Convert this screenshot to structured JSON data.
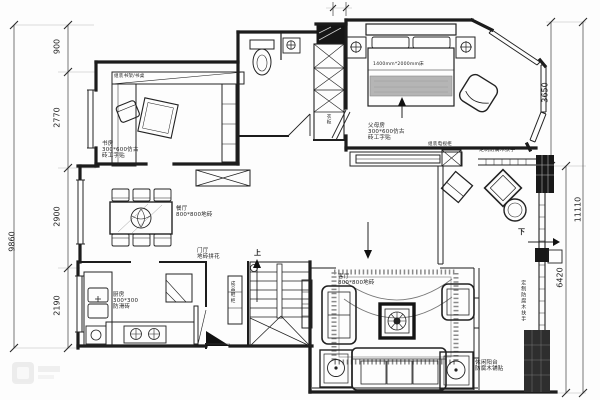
{
  "plan": {
    "dims": {
      "d900": "900",
      "d2770": "2770",
      "d2900": "2900",
      "d2190": "2190",
      "total_left": "9860",
      "d3650": "3650",
      "d6420": "6420",
      "total_right": "11110"
    },
    "rooms": {
      "study": {
        "l1": "书房",
        "l2": "300*600仿古",
        "l3": "砖工字贴"
      },
      "parents": {
        "l1": "父母房",
        "l2": "300*600仿古",
        "l3": "砖工字贴"
      },
      "dining": {
        "l1": "餐厅",
        "l2": "800*800地砖"
      },
      "living": {
        "l1": "客厅",
        "l2": "800*800地砖"
      },
      "kitchen": {
        "l1": "厨房",
        "l2": "300*300",
        "l3": "防滑砖"
      },
      "hall": {
        "l1": "门厅",
        "l2": "地砖拼花"
      },
      "balcony": {
        "l1": "休闲阳台",
        "l2": "防腐木铺贴"
      }
    },
    "furniture": {
      "bookshelf": "组装书架/书桌",
      "bed": "1400mm*2000mm床",
      "tv_cabinet": "组装电视柜",
      "handrail_top": "定制防腐木扶手",
      "handrail_side": "定制防腐木扶手",
      "shoe_cabinet": "成品鞋柜",
      "wardrobe": "衣柜"
    },
    "stairs": {
      "up": "上",
      "down": "下"
    }
  }
}
